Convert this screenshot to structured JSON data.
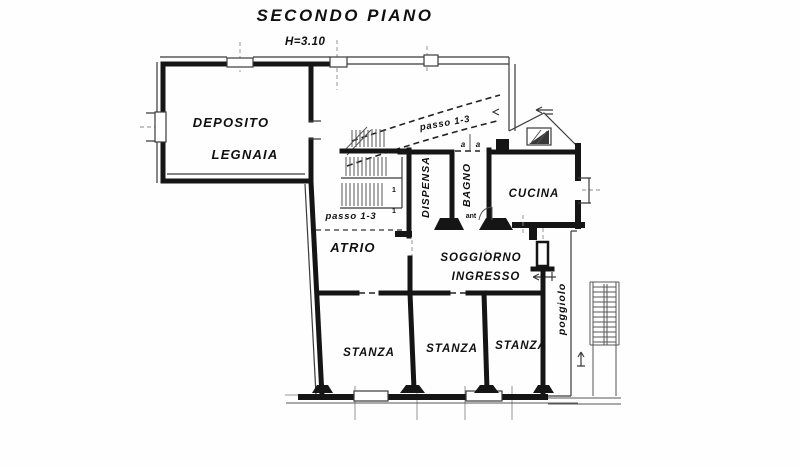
{
  "title": "SECONDO PIANO",
  "height_note": "H=3.10",
  "ink_color": "#151515",
  "rooms": {
    "deposito_line1": "DEPOSITO",
    "deposito_line2": "LEGNAIA",
    "dispensa": "DISPENSA",
    "bagno": "BAGNO",
    "cucina": "CUCINA",
    "atrio": "ATRIO",
    "soggiorno_line1": "SOGGIORNO",
    "soggiorno_line2": "INGRESSO",
    "stanza1": "STANZA",
    "stanza2": "STANZA",
    "stanza3": "STANZA",
    "poggiolo": "poggiolo",
    "anti": "ant"
  },
  "annotations": {
    "passo_upper": "passo 1-3",
    "passo_lower": "passo 1-3",
    "section_left": "a",
    "section_right": "a",
    "stair_mark1": "1",
    "stair_mark2": "1"
  }
}
